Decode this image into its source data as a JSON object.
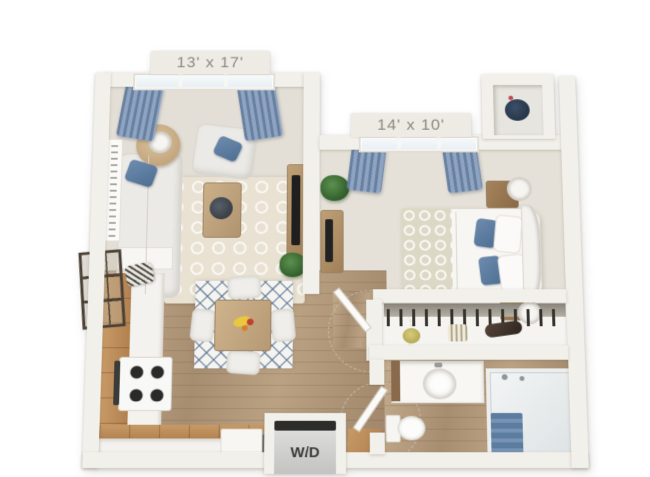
{
  "floor_plan": {
    "living_room": {
      "dimensions": "13' x 17'"
    },
    "bedroom": {
      "dimensions": "14' x 10'"
    },
    "laundry": {
      "label": "W/D"
    }
  },
  "colors": {
    "curtain_blue": "#7089ae",
    "pillow_accent_blue": "#5d80a5",
    "carpet_beige": "#e3dfd6",
    "wood_floor_tan": "#b2987a",
    "cabinet_wood": "#c2996b",
    "wall_white": "#f2f0ea",
    "label_text_gray": "#8a8781",
    "rug_lattice_blue": "#5e7a9b"
  }
}
